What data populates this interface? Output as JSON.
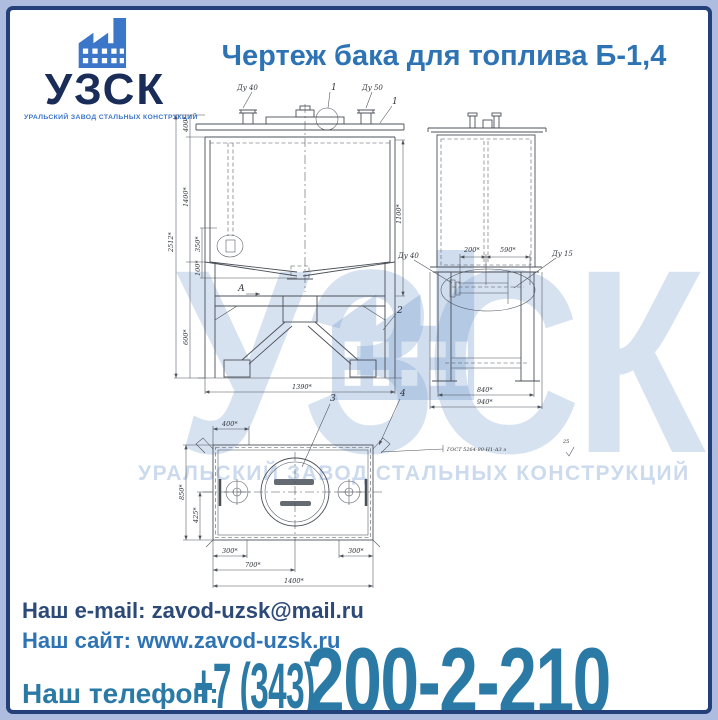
{
  "logo": {
    "name": "УЗСК",
    "subtitle": "УРАЛЬСКИЙ ЗАВОД СТАЛЬНЫХ КОНСТРУКЦИЙ",
    "icon_color": "#3b76c9",
    "name_color": "#1a2c58"
  },
  "header": {
    "title": "Чертеж бака для топлива Б-1,4",
    "color": "#2e74b5"
  },
  "watermark": {
    "text": "УЗСК",
    "subtext": "УРАЛЬСКИЙ ЗАВОД СТАЛЬНЫХ КОНСТРУКЦИЙ"
  },
  "drawing": {
    "front": {
      "dim_overall": "2512*",
      "dim_top": "400*",
      "dim_body": "1400*",
      "dim_ellipse": "350*",
      "dim_hopper": "100*",
      "dim_frame": "600*",
      "dim_right": "1100*",
      "dim_width": "1390*",
      "noz_left": "Ду 40",
      "noz_right": "Ду 50",
      "callout_top": "1",
      "callout_right": "1",
      "callout_frame": "2",
      "section": "А"
    },
    "side": {
      "dim_200": "200*",
      "dim_590": "590*",
      "dim_840": "840*",
      "dim_940": "940*",
      "lbl_du40": "Ду 40",
      "lbl_du15": "Ду 15"
    },
    "plan": {
      "dim_400": "400*",
      "dim_850": "850*",
      "dim_425": "425*",
      "dim_300_left": "300*",
      "dim_300_right": "300*",
      "dim_700": "700*",
      "dim_1400": "1400*",
      "callout_3": "3",
      "callout_4": "4",
      "weld_note": "ГОСТ 5264-80-Н1-Δ3 э",
      "weld_num": "25"
    }
  },
  "contacts": {
    "email_label": "Наш e-mail:",
    "email_value": "zavod-uzsk@mail.ru",
    "site_label": "Наш сайт:",
    "site_value": "www.zavod-uzsk.ru",
    "phone_label": "Наш телефон:",
    "phone_prefix": "+7 (343)",
    "phone_number": "200-2-210",
    "phone_color": "#2b7aa6"
  }
}
